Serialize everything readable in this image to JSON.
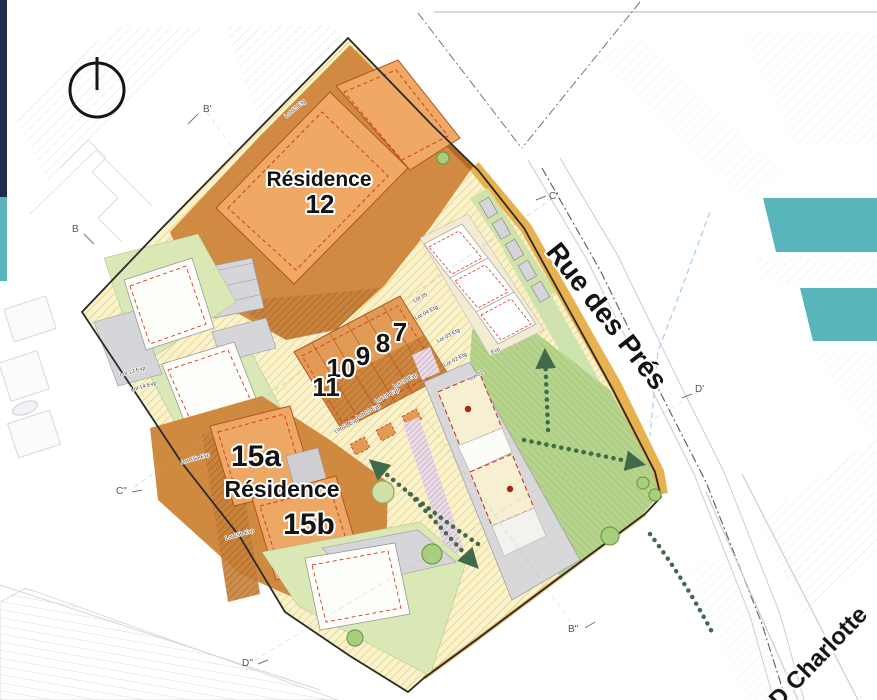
{
  "palette": {
    "navy": "#1e2c4d",
    "teal": "#57b5bb",
    "site_yellow": "#f9f2cf",
    "orange_zone": "#d18a42",
    "orange_building": "#efa964",
    "green_lawn": "#b7d48c",
    "red_dash": "#c23a28",
    "arrow_green": "#41694c"
  },
  "compass": {
    "type": "north-indicator"
  },
  "residence12": {
    "name": "Résidence",
    "number": "12"
  },
  "residence15": {
    "unit_a": "15a",
    "name": "Résidence",
    "unit_b": "15b"
  },
  "unit_numbers": [
    "7",
    "8",
    "9",
    "10",
    "11"
  ],
  "streets": {
    "rue_des_pres": "Rue des Prés",
    "gd_charlotte": "D Charlotte"
  },
  "section_markers": {
    "b_prime": "B'",
    "b": "B",
    "c_prime": "C'",
    "c_second": "C''",
    "d_prime": "D'",
    "d_second": "D''",
    "b_second": "B''"
  },
  "lot_labels": {
    "lot12": "Lot 12 Etg",
    "lot05": "Lot 05",
    "lot04": "Lot 04 Etg",
    "lot03": "Lot 03 Etg",
    "lot02": "Lot 02 Etg",
    "lot01": "Lot 01",
    "evp": "Evp",
    "lot08": "Lot 08 Evp",
    "lot09": "Lot 09 Evp",
    "lot10": "Lot 10 Evp",
    "lot11": "Lot 11 Evp",
    "lot13": "Lot 13 Evp",
    "lot14": "Lot 14 Evp",
    "lot15a": "Lot 15a Evp",
    "lot15b": "Lot 15b Evp"
  }
}
